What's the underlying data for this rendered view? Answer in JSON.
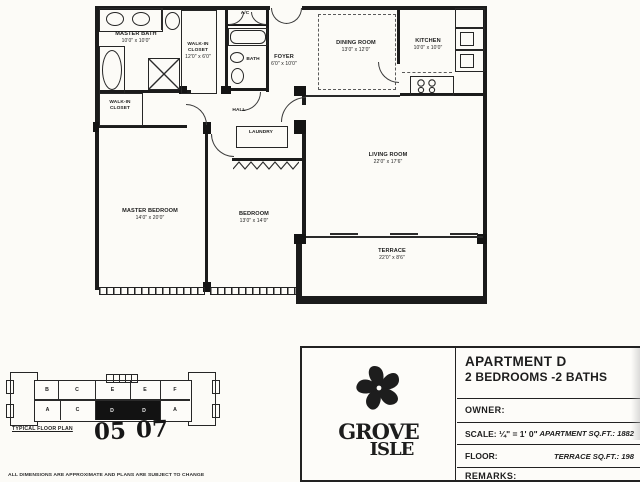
{
  "page": {
    "disclaimer": "ALL DIMENSIONS ARE APPROXIMATE AND PLANS ARE SUBJECT TO CHANGE"
  },
  "rooms": {
    "master_bath": {
      "name": "MASTER BATH",
      "dims": "10'0\" x 10'0\""
    },
    "walkin_center": {
      "name": "WALK-IN CLOSET",
      "dims": "12'0\" x 6'0\""
    },
    "walkin_master": {
      "name": "WALK-IN CLOSET",
      "dims": ""
    },
    "bath": {
      "name": "BATH",
      "dims": ""
    },
    "ac": {
      "name": "A/C",
      "dims": ""
    },
    "foyer": {
      "name": "FOYER",
      "dims": "6'0\" x 10'0\""
    },
    "hall": {
      "name": "HALL",
      "dims": ""
    },
    "laundry": {
      "name": "LAUNDRY",
      "dims": ""
    },
    "dining": {
      "name": "DINING ROOM",
      "dims": "13'0\" x 12'0\""
    },
    "kitchen": {
      "name": "KITCHEN",
      "dims": "10'0\" x 10'0\""
    },
    "master_bedroom": {
      "name": "MASTER BEDROOM",
      "dims": "14'0\" x 20'0\""
    },
    "bedroom": {
      "name": "BEDROOM",
      "dims": "13'0\" x 14'0\""
    },
    "living": {
      "name": "LIVING ROOM",
      "dims": "22'0\" x 17'6\""
    },
    "terrace": {
      "name": "TERRACE",
      "dims": "22'0\" x 8'6\""
    }
  },
  "title_block": {
    "apartment": "APARTMENT D",
    "config": "2 BEDROOMS -2 BATHS",
    "owner_label": "OWNER:",
    "scale_label": "SCALE: ¼\" = 1' 0\"",
    "apartment_sqft": "APARTMENT SQ.FT.: 1882",
    "floor_label": "FLOOR:",
    "terrace_sqft": "TERRACE SQ.FT.: 198",
    "remarks_label": "REMARKS:",
    "logo_line1": "GROVE",
    "logo_line2": "ISLE"
  },
  "key_plan": {
    "caption": "TYPICAL FLOOR PLAN",
    "top_units": [
      "B",
      "C",
      "E",
      "E",
      "F"
    ],
    "bottom_units": [
      "A",
      "C",
      "D",
      "D",
      "A"
    ],
    "handwritten_left": "05",
    "handwritten_right": "07"
  },
  "colors": {
    "ink": "#1b1b1b",
    "paper": "#fcfbf7"
  }
}
